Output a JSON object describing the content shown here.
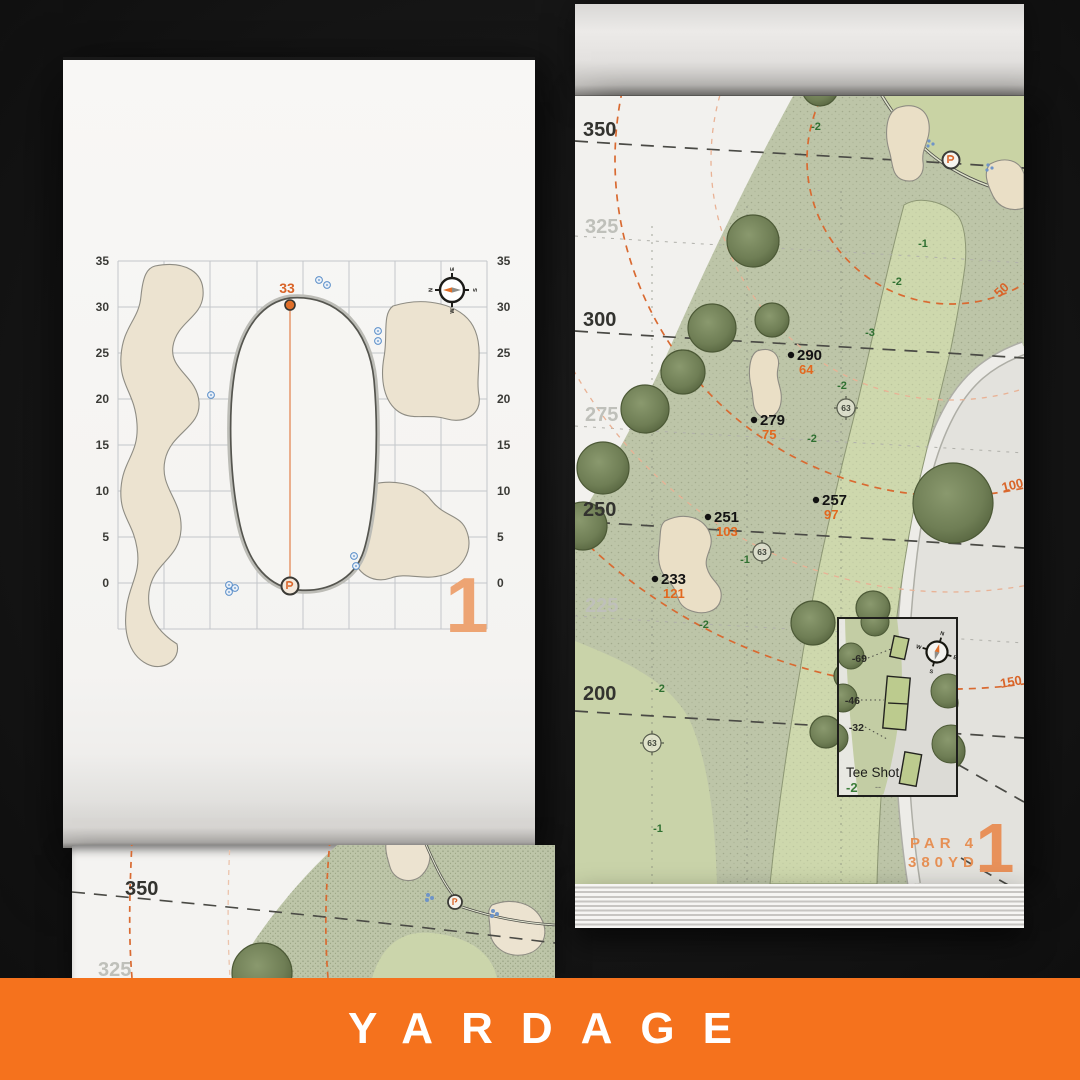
{
  "banner": {
    "title": "YARDAGE"
  },
  "left_page": {
    "hole_number": "1",
    "green_front_yardage": "33",
    "axis_ticks": [
      "35",
      "30",
      "25",
      "20",
      "15",
      "10",
      "5",
      "0"
    ],
    "compass": {
      "n": "N",
      "e": "E",
      "s": "S",
      "w": "W"
    }
  },
  "right_page": {
    "hole_number": "1",
    "par": "PAR 4",
    "total_yardage": "380YD",
    "distance_labels": [
      "350",
      "325",
      "300",
      "275",
      "250",
      "225",
      "200"
    ],
    "arc_labels": [
      "50",
      "100",
      "150"
    ],
    "markers": [
      {
        "carry": "290",
        "to_front": "64"
      },
      {
        "carry": "279",
        "to_front": "75"
      },
      {
        "carry": "257",
        "to_front": "97"
      },
      {
        "carry": "251",
        "to_front": "103"
      },
      {
        "carry": "233",
        "to_front": "121"
      }
    ],
    "elevation_labels": [
      "-2",
      "-1",
      "-2",
      "-3",
      "-2",
      "-2",
      "-1",
      "-2",
      "-2",
      "-1"
    ],
    "sprinkler_heads": [
      "63",
      "63",
      "63"
    ],
    "compass": {
      "n": "N",
      "e": "E",
      "s": "S",
      "w": "W"
    },
    "tee_inset": {
      "title": "Tee Shot",
      "elevation": "-2",
      "tee_markers": [
        "-69",
        "-46",
        "-32"
      ],
      "ellipsis": "--"
    }
  },
  "under_page": {
    "distance_labels": [
      "350",
      "325"
    ]
  }
}
